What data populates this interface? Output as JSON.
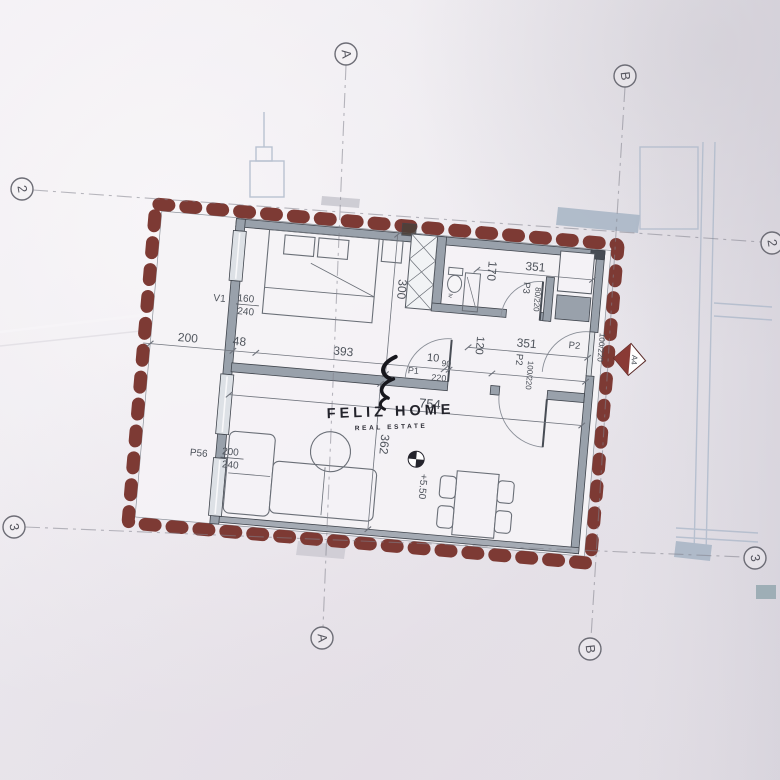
{
  "watermark": {
    "brand": "FELIZ HOME",
    "tagline": "REAL ESTATE"
  },
  "grid": {
    "col_a": "A",
    "col_b": "B",
    "row_2": "2",
    "row_3": "3"
  },
  "annotations": {
    "level": "+5.50",
    "section_marker": "A4"
  },
  "dimensions": {
    "terrace_width": "200",
    "wall_offset": "48",
    "bedroom_width": "393",
    "door_offset": "10",
    "door_width": "90",
    "hall_depth": "120",
    "hall_width_upper": "351",
    "hall_width_lower": "351",
    "bath_width": "170",
    "bedroom_depth": "300",
    "living_width": "754",
    "living_depth": "362"
  },
  "openings": {
    "v1": {
      "id": "V1",
      "width": "160",
      "height": "240"
    },
    "p1": {
      "id": "P1",
      "height": "220"
    },
    "p2": {
      "id": "P2",
      "size": "100/220"
    },
    "p2_entry": {
      "id": "P2",
      "size": "100/220"
    },
    "p3": {
      "id": "P3",
      "size": "80/220"
    },
    "p56": {
      "id": "P56",
      "width": "200",
      "height": "240"
    },
    "lv": "lv"
  },
  "colors": {
    "paper": "#e9e6eb",
    "insulation_red": "#7d3a34",
    "wall_gray": "#99a1ab",
    "line_dark": "#474c54",
    "dim_text": "#4b5058",
    "faint_blue": "#b3bdcd",
    "watermark_ink": "#20202a"
  }
}
